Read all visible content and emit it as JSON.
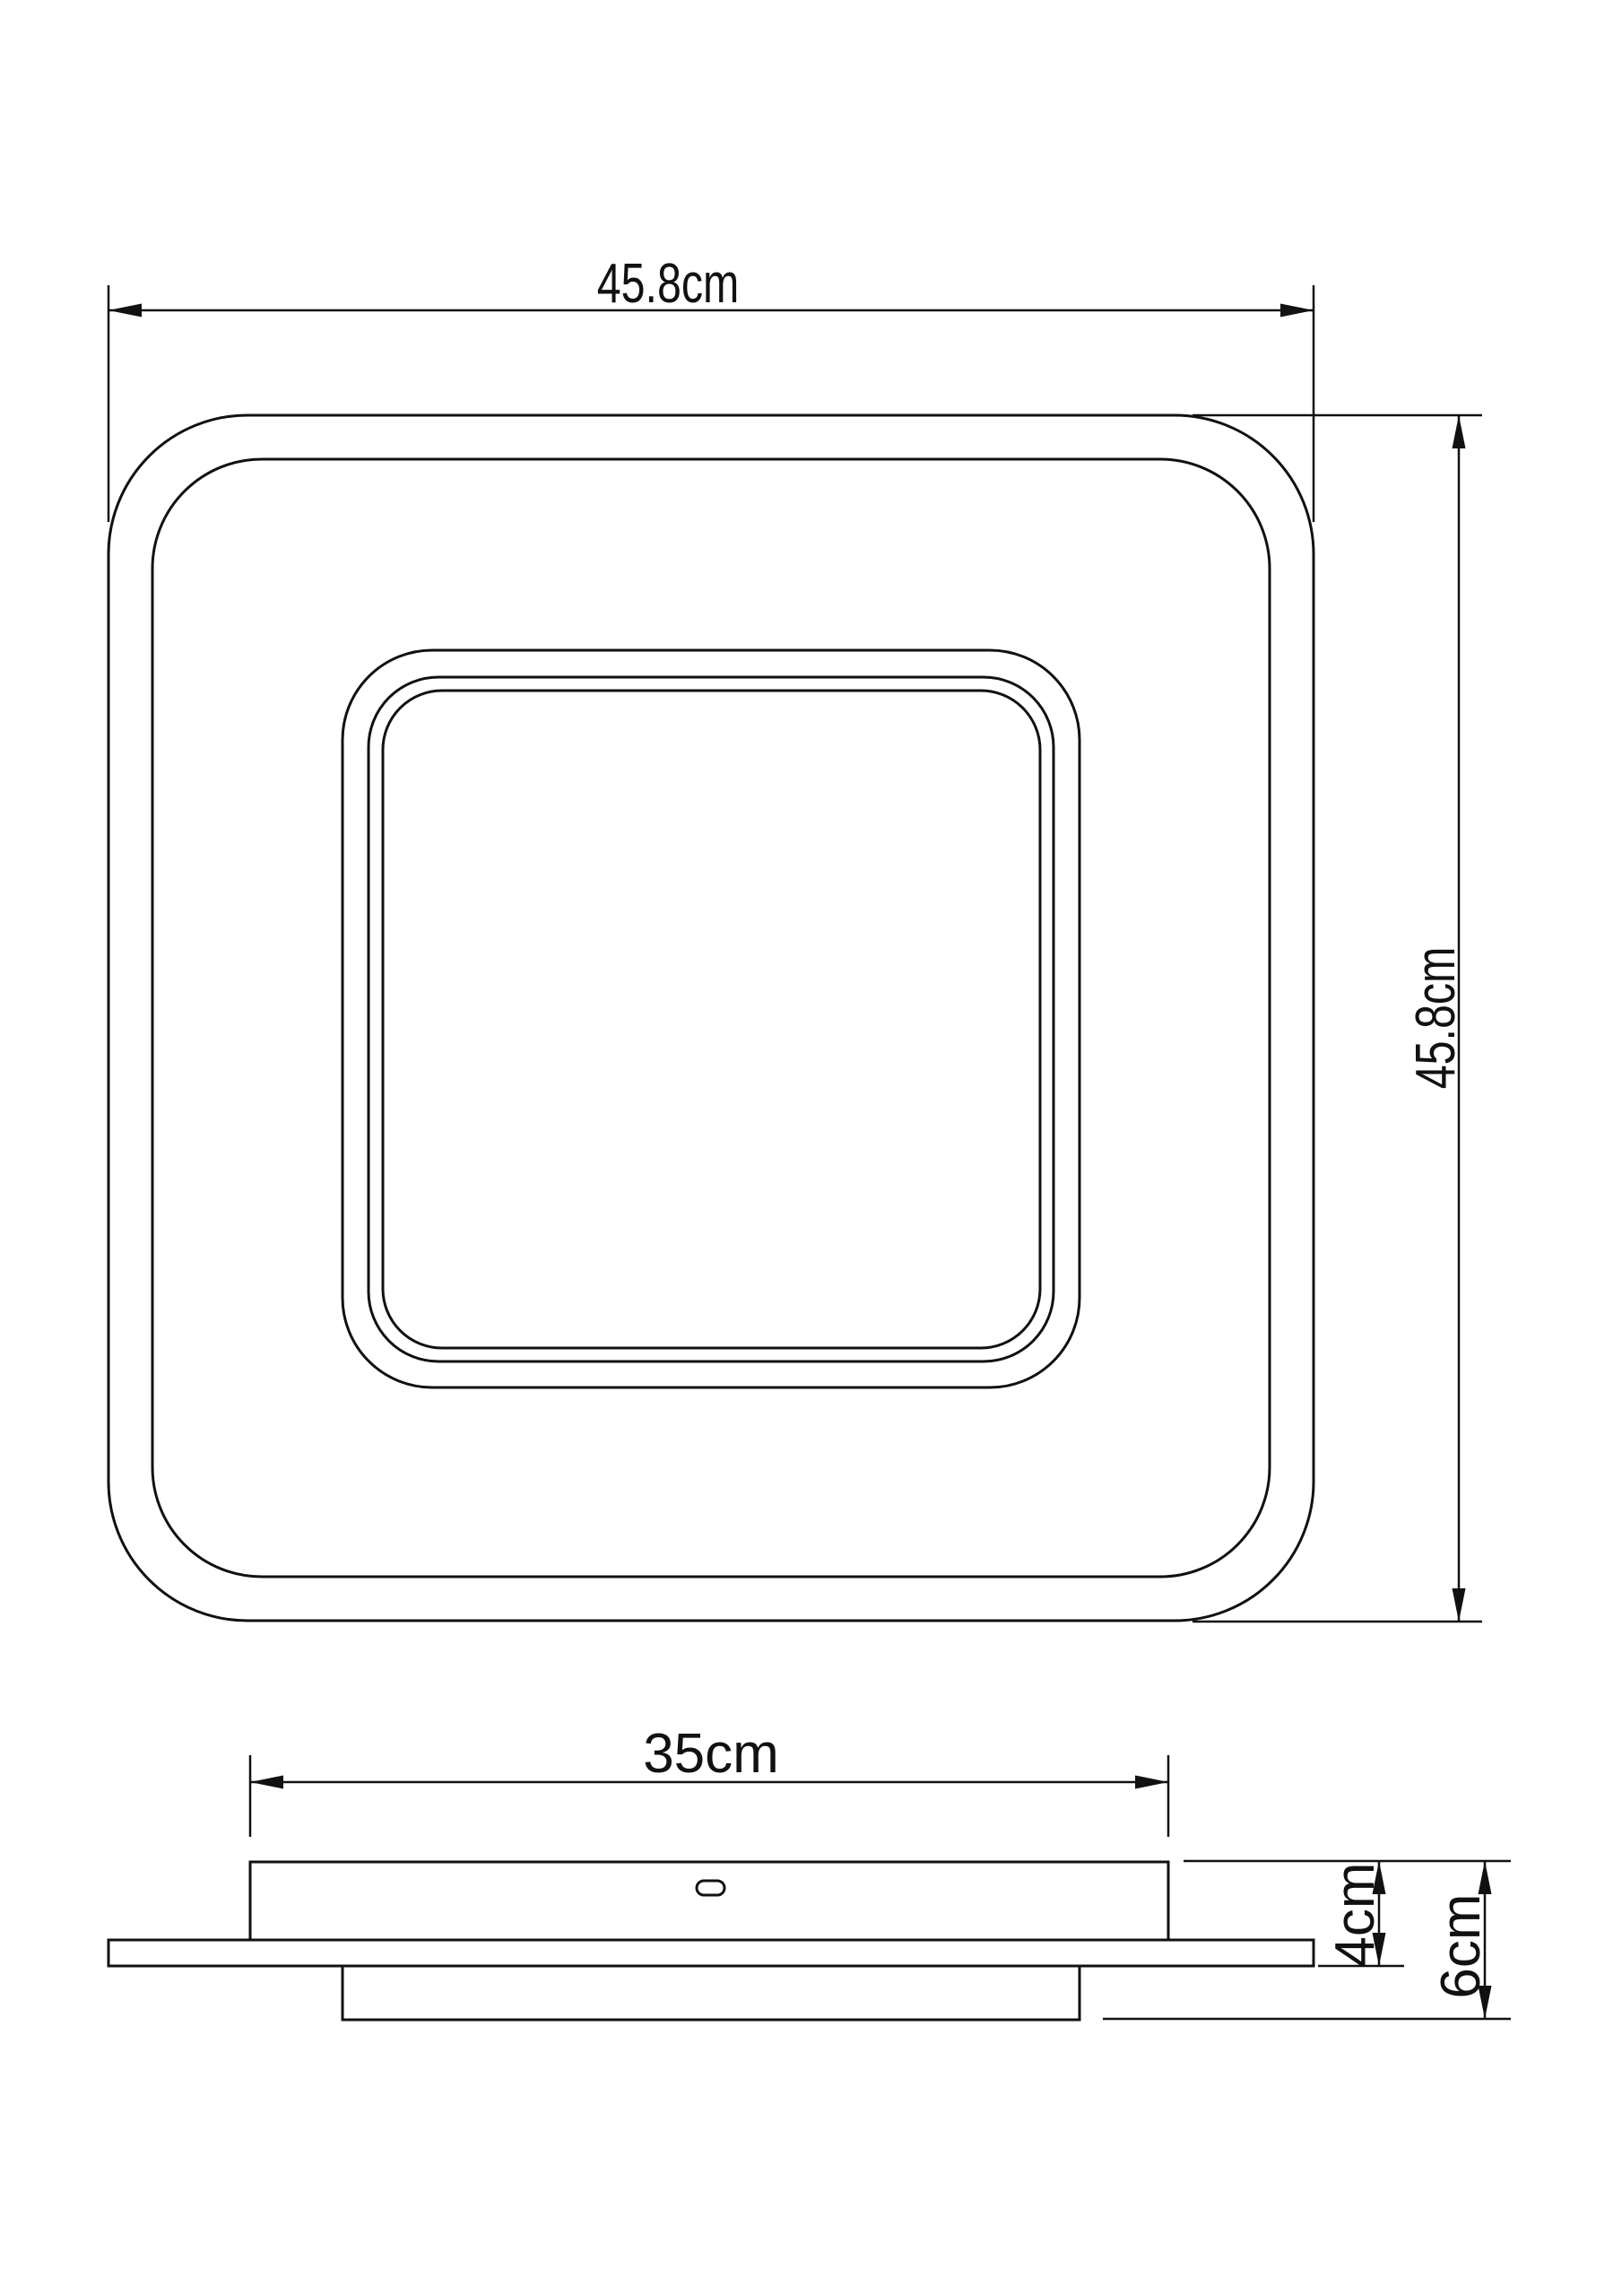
{
  "page": {
    "background": "#ffffff",
    "line_color": "#111111",
    "type_note": "technical dimension drawing of square ceiling light fixture"
  },
  "top_view": {
    "width_label": "45.8cm",
    "height_label": "45.8cm"
  },
  "side_view": {
    "mount_width_label": "35cm",
    "mount_depth_label": "4cm",
    "total_depth_label": "6cm"
  }
}
